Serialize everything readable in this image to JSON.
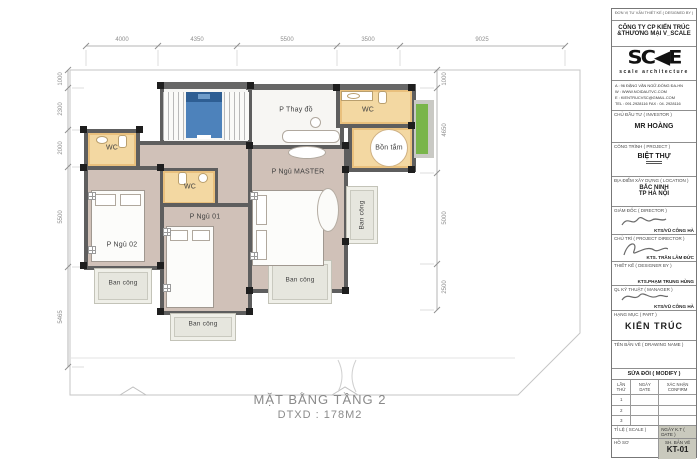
{
  "sheet": {
    "plan_title": "MẶT BẰNG TẦNG 2",
    "plan_subtitle": "DTXD : 178M2"
  },
  "rooms": {
    "wc": "WC",
    "bedroom2": "P Ngủ 02",
    "bedroom1": "P Ngủ 01",
    "master": "P Ngủ MASTER",
    "dressing": "P Thay đồ",
    "bathtub": "Bồn tắm",
    "balcony": "Ban công"
  },
  "dimensions": {
    "top": [
      "4000",
      "4350",
      "5500",
      "3500",
      "9025"
    ],
    "left": [
      "1000",
      "2300",
      "2000",
      "5500",
      "5465"
    ],
    "right": [
      "1000",
      "4650",
      "5000",
      "2500"
    ]
  },
  "title_block": {
    "header": "ĐƠN VỊ TƯ VẤN THIẾT KẾ ( DESIGNED BY )",
    "company_line1": "CÔNG TY  CP  KIẾN TRÚC",
    "company_line2": "&THƯƠNG MẠI V_SCALE",
    "logo_text": "SC◀E",
    "logo_sub": "scale architecture",
    "address": "A  :  96 ĐẶNG VĂN NGỮ-ĐỐNG ĐA-HN",
    "website": "W :  WWW.NOIDAUTVC.COM",
    "email": "E  :  KIENTRUCVSC@GMAIL.COM",
    "phone": "TEL : 091.2928116      FAX : 04. 2928116",
    "investor_label": "CHỦ ĐẦU TƯ ( INVESTOR )",
    "investor_name": "MR HOÀNG",
    "project_label": "CÔNG TRÌNH ( PROJECT )",
    "project_name": "BIỆT THỰ",
    "location_label": "ĐỊA ĐIỂM XÂY DỰNG ( LOCATION )",
    "location_line1": "BẮC NINH",
    "location_line2": "TP HÀ NỘI",
    "director_label": "GIÁM ĐỐC ( DIRECTOR )",
    "director_name": "KTS/VŨ CÔNG HÀ",
    "chief_label": "CHỦ TRÌ ( PROJECT DIRECTOR )",
    "chief_name": "KTS. TRẦN LÂM ĐỨC",
    "designer_label": "THIẾT KẾ ( DESIGNER BY )",
    "designer_name": "KTS.PHẠM TRUNG HÙNG",
    "manager_label": "QL KỸ THUẬT ( MANAGER )",
    "manager_name": "KTS/VŨ CÔNG HÀ",
    "part_label": "HẠNG MỤC ( PART )",
    "part_name": "KIẾN TRÚC",
    "drawing_name_label": "TÊN BẢN VẼ ( DRAWING NAME )",
    "modify_label": "SỬA ĐỔI ( MODIFY )",
    "modify_col1": "LẦN\nTHỨ",
    "modify_col2": "NGÀY\nDATE",
    "modify_col3": "XÁC NHẬN\nCONFIRM",
    "modify_rows": [
      "1",
      "2",
      "3"
    ],
    "scale_label": "TỈ LỆ ( SCALE )",
    "date_label": "NGÀY K.T ( DATE )",
    "dossier_label": "HỒ SƠ",
    "sheet_label": "SH. BẢN VẼ",
    "sheet_no": "KT-01"
  },
  "colors": {
    "wall": "#5e5e5e",
    "floor_main": "#d0c1b8",
    "floor_wc": "#f3d8a2",
    "balcony": "#e6e6de",
    "elevator": "#4d82bb",
    "window_green": "#79b54a"
  }
}
